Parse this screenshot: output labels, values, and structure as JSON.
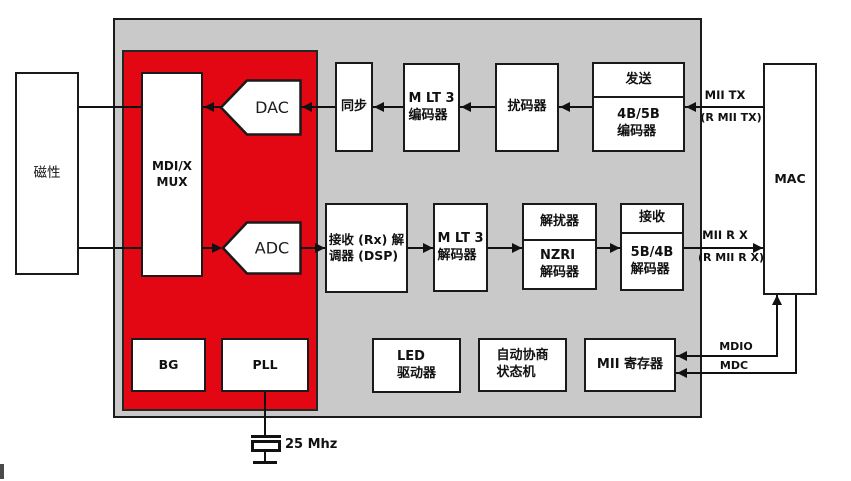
{
  "diagram": {
    "type": "block-diagram",
    "subject": "Ethernet PHY 功能框图"
  },
  "colors": {
    "chip_background": "#c9c9c9",
    "analog_front_end": "#e30613",
    "block_fill": "#ffffff",
    "line": "#111111"
  },
  "blocks": {
    "magnetics": {
      "label": "磁性"
    },
    "mdix_mux": {
      "lines": [
        "MDI/X",
        "MUX"
      ]
    },
    "dac": {
      "label": "DAC"
    },
    "adc": {
      "label": "ADC"
    },
    "sync": {
      "label": "同步"
    },
    "mlt3_encoder": {
      "lines": [
        "M LT 3",
        "编码器"
      ]
    },
    "scrambler": {
      "label": "扰码器"
    },
    "tx_4b5b_encoder": {
      "header": "发送",
      "lines": [
        "4B/5B",
        "编码器"
      ]
    },
    "rx_dsp": {
      "lines": [
        "接收 (Rx) 解",
        "调器 (DSP)"
      ]
    },
    "mlt3_decoder": {
      "lines": [
        "M LT 3",
        "解码器"
      ]
    },
    "descrambler": {
      "header": "解扰器",
      "lines": [
        "NZRI",
        "解码器"
      ]
    },
    "rx_5b4b_decoder": {
      "header": "接收",
      "lines": [
        "5B/4B",
        "解码器"
      ]
    },
    "bg": {
      "label": "BG"
    },
    "pll": {
      "label": "PLL"
    },
    "led_driver": {
      "lines": [
        "LED",
        "驱动器"
      ]
    },
    "autoneg_state_machine": {
      "lines": [
        "自动协商",
        "状态机"
      ]
    },
    "mii_registers": {
      "label": "MII 寄存器"
    },
    "mac": {
      "label": "MAC"
    }
  },
  "labels": {
    "mii_tx": "MII TX",
    "rmii_tx": "(R MII TX)",
    "mii_rx": "MII R X",
    "rmii_rx": "(R MII R X)",
    "mdio": "MDIO",
    "mdc": "MDC",
    "crystal_frequency": "25 Mhz"
  }
}
